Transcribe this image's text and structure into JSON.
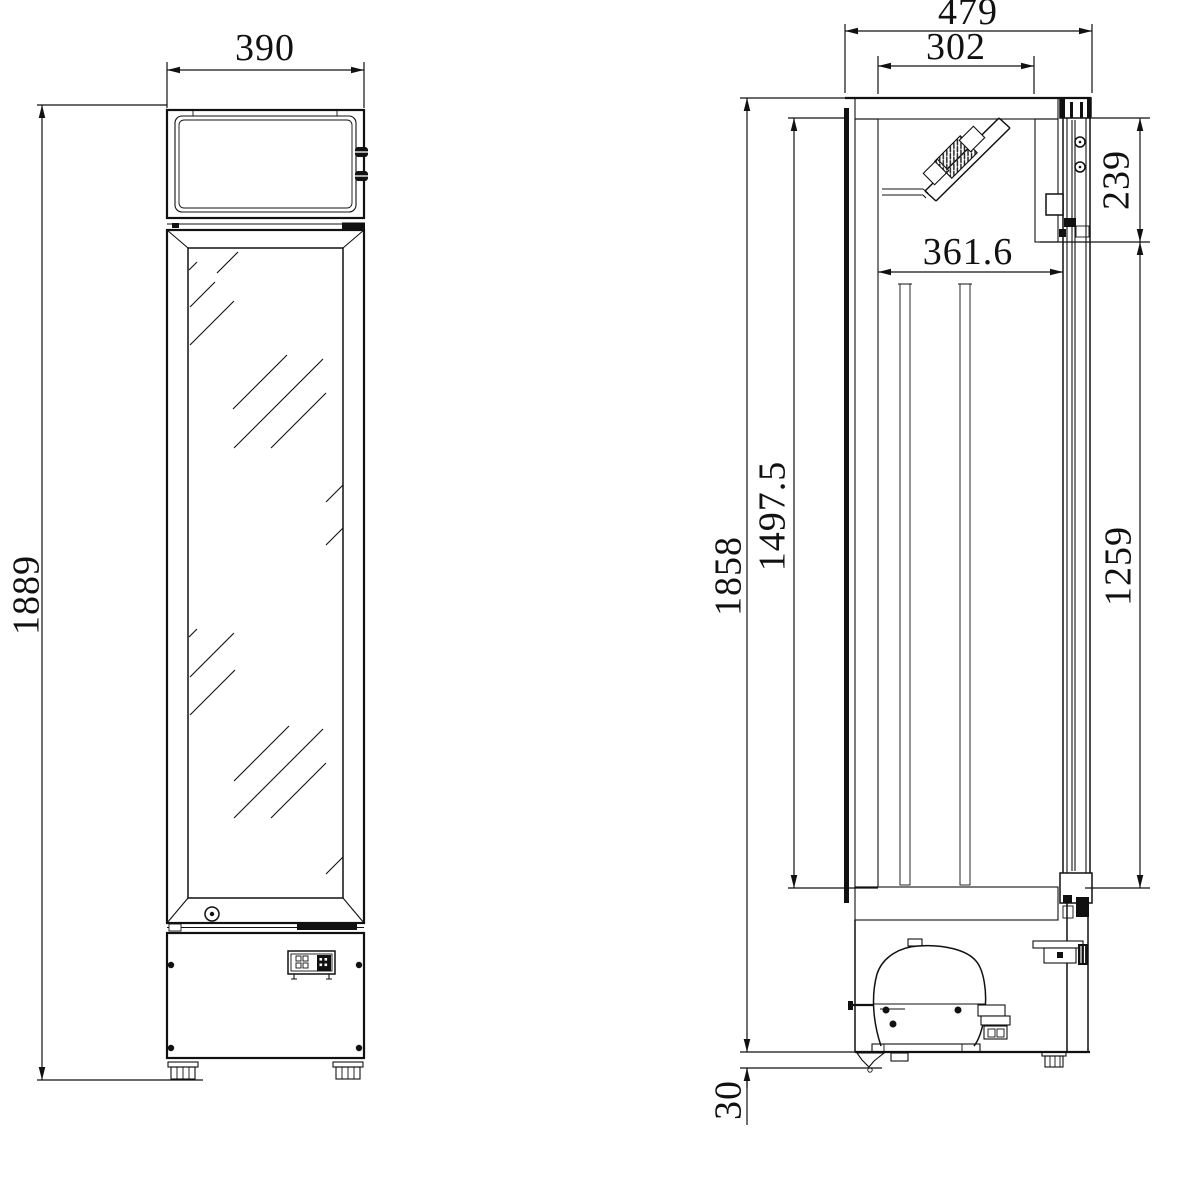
{
  "drawing": {
    "type": "refrigerated display cabinet dimensional drawing",
    "views": {
      "front": "front-elevation",
      "side": "side-section"
    }
  },
  "dims": {
    "front_width": "390",
    "overall_height": "1889",
    "depth": "479",
    "top_opening_depth": "302",
    "canopy_front_height": "239",
    "interior_depth": "361.6",
    "door_height": "1497.5",
    "cabinet_height": "1858",
    "interior_height": "1259",
    "base_clearance": "30"
  },
  "colors": {
    "line": "#111111",
    "background": "#ffffff",
    "hatch": "#222222"
  }
}
